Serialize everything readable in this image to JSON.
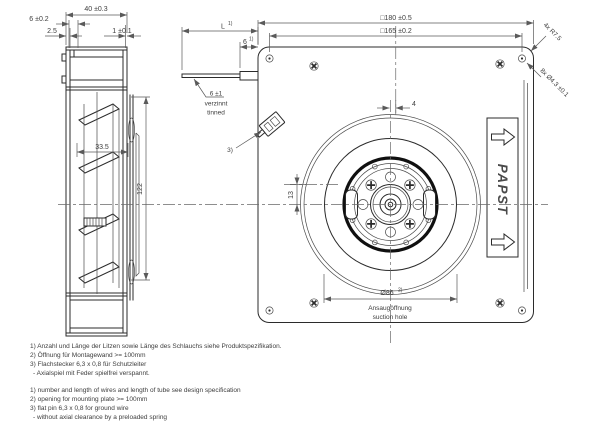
{
  "colors": {
    "background": "#ffffff",
    "line": "#2b2b2b",
    "dim": "#5a5a5a",
    "text": "#3d3d3d"
  },
  "side_view": {
    "dim_depth": "40 ±0.3",
    "dim_step": "6 ±0.2",
    "dim_plate": "2.5",
    "dim_gap": "1 ±0.1",
    "dim_inner": "33.5",
    "dim_height": "122"
  },
  "lead_wire": {
    "dim_length": "L",
    "dim_length_note": "1)",
    "dim_exit": "6",
    "dim_exit_note": "1)",
    "tinned_dim": "6 ±1",
    "tinned_de": "verzinnt",
    "tinned_en": "tinned"
  },
  "rear_view": {
    "dim_outer_square": "□180 ±0.5",
    "dim_hole_square": "□165 ±0.2",
    "dim_center_offset_x": "4",
    "dim_center_offset_y": "13",
    "note_corner_radius": "4x R7.5",
    "note_mounting_holes": "8x Ø4.3 ±0.1",
    "dim_suction": "Ø86",
    "dim_suction_note": "2)",
    "suction_label_de": "Ansaugöffnung",
    "suction_label_en": "suction hole",
    "connector_note": "3)",
    "brand": "PAPST"
  },
  "footnotes_de": [
    "1) Anzahl und Länge der Litzen sowie Länge des Schlauchs siehe Produktspezifikation.",
    "2) Öffnung für Montagewand >= 100mm",
    "3) Flachstecker 6,3 x 0,8 für Schutzleiter",
    "-  Axialspiel mit Feder spielfrei verspannt."
  ],
  "footnotes_en": [
    "1) number and length of wires and length of tube see design specification",
    "2) opening for mounting plate >= 100mm",
    "3) flat pin 6,3 x 0,8 for ground wire",
    "-  without axial clearance by a preloaded spring"
  ]
}
